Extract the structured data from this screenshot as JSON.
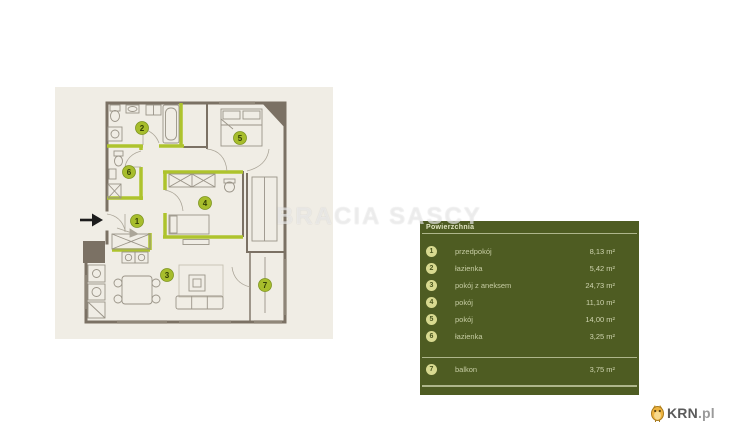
{
  "watermark": "BRACIA SASCY",
  "panel": {
    "header": "Powierzchnia",
    "rows": [
      {
        "num": "1",
        "label": "przedpokój",
        "area": "8,13 m²"
      },
      {
        "num": "2",
        "label": "łazienka",
        "area": "5,42 m²"
      },
      {
        "num": "3",
        "label": "pokój z aneksem",
        "area": "24,73 m²"
      },
      {
        "num": "4",
        "label": "pokój",
        "area": "11,10 m²"
      },
      {
        "num": "5",
        "label": "pokój",
        "area": "14,00 m²"
      },
      {
        "num": "6",
        "label": "łazienka",
        "area": "3,25 m²"
      }
    ],
    "extra_row": {
      "num": "7",
      "label": "balkon",
      "area": "3,75 m²"
    }
  },
  "floorplan": {
    "room_numbers": [
      "1",
      "2",
      "3",
      "4",
      "5",
      "6",
      "7"
    ],
    "colors": {
      "wall": "#7b7164",
      "highlight": "#aec32d",
      "card_bg": "#f0ede5",
      "panel_bg": "#4e5c22",
      "marker_fill": "#a7bd2c"
    }
  },
  "logo": {
    "text_main": "KRN",
    "text_suffix": ".pl"
  }
}
